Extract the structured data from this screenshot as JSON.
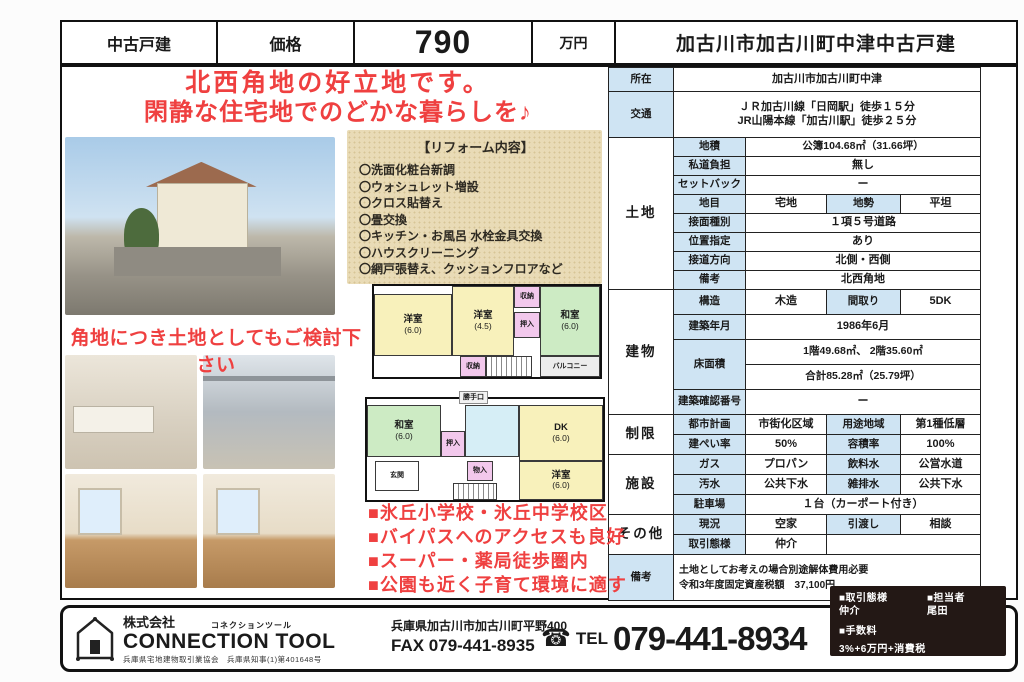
{
  "colors": {
    "accent_red": "#ef4040",
    "table_label_bg": "#cfe4f3",
    "reform_bg": "#e9dbb6",
    "footer_box_bg": "#231815"
  },
  "header": {
    "property_type": "中古戸建",
    "price_label": "価格",
    "price_value": "790",
    "price_unit": "万円",
    "title": "加古川市加古川町中津中古戸建"
  },
  "catchphrase": {
    "line1": "北西角地の好立地です。",
    "line2": "閑静な住宅地でのどかな暮らしを♪"
  },
  "reform": {
    "title": "【リフォーム内容】",
    "items": [
      "〇洗面化粧台新調",
      "〇ウォシュレット増設",
      "〇クロス貼替え",
      "〇畳交換",
      "〇キッチン・お風呂 水栓金具交換",
      "〇ハウスクリーニング",
      "〇網戸張替え、クッションフロアなど"
    ]
  },
  "land_note": "角地につき土地としてもご検討下さい",
  "selling_points": [
    "■氷丘小学校・氷丘中学校区",
    "■バイパスへのアクセスも良好",
    "■スーパー・薬局徒歩圏内",
    "■公園も近く子育て環境に適す"
  ],
  "plan2f": {
    "room_a": "洋室",
    "room_a_size": "(6.0)",
    "room_b": "洋室",
    "room_b_size": "(4.5)",
    "room_c": "和室",
    "room_c_size": "(6.0)",
    "closet_top": "収納",
    "closet_mid": "押入",
    "closet_bottom": "収納",
    "balcony": "バルコニー"
  },
  "plan1f": {
    "room_a": "和室",
    "room_a_size": "(6.0)",
    "room_b": "DK",
    "room_b_size": "(6.0)",
    "room_c": "洋室",
    "room_c_size": "(6.0)",
    "entrance": "玄関",
    "closet_a": "押入",
    "closet_b": "物入",
    "back_door": "勝手口"
  },
  "spec": {
    "location": {
      "label": "所在",
      "value": "加古川市加古川町中津"
    },
    "access": {
      "label": "交通",
      "line1": "ＪＲ加古川線「日岡駅」徒歩１５分",
      "line2": "JR山陽本線「加古川駅」徒歩２５分"
    },
    "land": {
      "label": "土地",
      "area": {
        "label": "地積",
        "value": "公簿104.68㎡（31.66坪）"
      },
      "private_road": {
        "label": "私道負担",
        "value": "無し"
      },
      "setback": {
        "label": "セットバック",
        "value": "ー"
      },
      "category": {
        "label": "地目",
        "value": "宅地",
        "label2": "地勢",
        "value2": "平坦"
      },
      "road_type": {
        "label": "接面種別",
        "value": "１項５号道路"
      },
      "position": {
        "label": "位置指定",
        "value": "あり"
      },
      "road_direction": {
        "label": "接道方向",
        "value": "北側・西側"
      },
      "note": {
        "label": "備考",
        "value": "北西角地"
      }
    },
    "building": {
      "label": "建物",
      "structure": {
        "label": "構造",
        "value": "木造",
        "label2": "間取り",
        "value2": "5DK"
      },
      "built": {
        "label": "建築年月",
        "value": "1986年6月"
      },
      "floor_area": {
        "label": "床面積",
        "line1": "1階49.68㎡、 2階35.60㎡",
        "line2": "合計85.28㎡（25.79坪）"
      },
      "confirmation_no": {
        "label": "建築確認番号",
        "value": "ー"
      }
    },
    "restriction": {
      "label": "制限",
      "city_plan": {
        "label": "都市計画",
        "value": "市街化区域",
        "label2": "用途地域",
        "value2": "第1種低層"
      },
      "coverage": {
        "label": "建ぺい率",
        "value": "50%",
        "label2": "容積率",
        "value2": "100%"
      }
    },
    "facility": {
      "label": "施設",
      "gas": {
        "label": "ガス",
        "value": "プロパン",
        "label2": "飲料水",
        "value2": "公営水道"
      },
      "sewage": {
        "label": "汚水",
        "value": "公共下水",
        "label2": "雑排水",
        "value2": "公共下水"
      },
      "parking": {
        "label": "駐車場",
        "value": "１台（カーポート付き）"
      }
    },
    "other": {
      "label": "その他",
      "status": {
        "label": "現況",
        "value": "空家",
        "label2": "引渡し",
        "value2": "相談"
      },
      "transaction": {
        "label": "取引態様",
        "value": "仲介"
      }
    },
    "remarks": {
      "label": "備考",
      "line1": "土地としてお考えの場合別途解体費用必要",
      "line2": "令和3年度固定資産税額　37,100円"
    }
  },
  "footer": {
    "company_prefix": "株式会社",
    "company_kana": "コネクションツール",
    "company_name": "CONNECTION TOOL",
    "license": "兵庫県宅地建物取引業協会　兵庫県知事(1)第401648号",
    "address": "兵庫県加古川市加古川町平野400",
    "fax": "FAX 079-441-8935",
    "tel_icon": "☎",
    "tel_label": "TEL",
    "tel_number": "079-441-8934",
    "info_box": {
      "transaction_label": "■取引態様",
      "agent_label": "■担当者",
      "transaction_value": "仲介",
      "agent_value": "尾田",
      "fee_label": "■手数料",
      "fee_value": "3%+6万円+消費税"
    }
  }
}
